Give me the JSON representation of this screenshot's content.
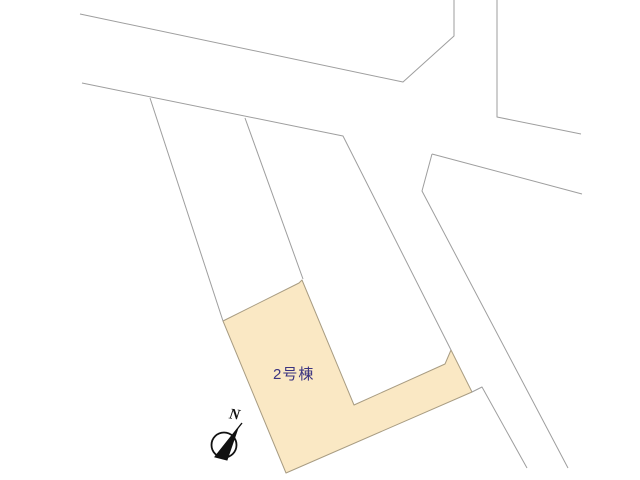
{
  "plan": {
    "background_color": "#ffffff",
    "line_color": "#9e9e9e",
    "line_width": 1,
    "parcel": {
      "label": "2号棟",
      "label_color": "#3a3380",
      "fill": "#fae8c4",
      "stroke": "#a89c82",
      "points": [
        [
          223,
          321
        ],
        [
          299,
          283
        ],
        [
          302,
          280
        ],
        [
          354,
          405
        ],
        [
          445,
          364
        ],
        [
          451,
          350
        ],
        [
          472,
          392
        ],
        [
          286,
          473
        ]
      ]
    },
    "lines": [
      {
        "name": "road-north-upper-edge",
        "points": [
          [
            80,
            14
          ],
          [
            403,
            82
          ],
          [
            454,
            36
          ],
          [
            454,
            0
          ]
        ]
      },
      {
        "name": "road-north-lower-edge-bending-southeast",
        "points": [
          [
            82,
            83
          ],
          [
            343,
            136
          ],
          [
            451,
            350
          ]
        ]
      },
      {
        "name": "road-top-vertical-right-edge",
        "points": [
          [
            497,
            0
          ],
          [
            497,
            117
          ],
          [
            581,
            134
          ]
        ]
      },
      {
        "name": "road-upper-right-lower-edge",
        "points": [
          [
            432,
            154
          ],
          [
            582,
            194
          ]
        ]
      },
      {
        "name": "road-southeast-right-edge",
        "points": [
          [
            432,
            154
          ],
          [
            422,
            191
          ],
          [
            568,
            468
          ]
        ]
      },
      {
        "name": "parcel-boundary-left",
        "points": [
          [
            150,
            98
          ],
          [
            223,
            321
          ]
        ]
      },
      {
        "name": "parcel-boundary-middle",
        "points": [
          [
            245,
            118
          ],
          [
            303,
            279
          ]
        ]
      },
      {
        "name": "road-southeast-left-edge-lower",
        "points": [
          [
            472,
            392
          ],
          [
            482,
            387
          ],
          [
            527,
            468
          ]
        ]
      }
    ],
    "compass": {
      "label": "N",
      "color": "#111111",
      "center": [
        224,
        445
      ],
      "radius": 12.5,
      "needle_line": [
        [
          215,
          457
        ],
        [
          242,
          423
        ]
      ],
      "needle_triangle": [
        [
          238,
          428
        ],
        [
          215,
          457
        ],
        [
          227,
          460
        ]
      ]
    }
  }
}
